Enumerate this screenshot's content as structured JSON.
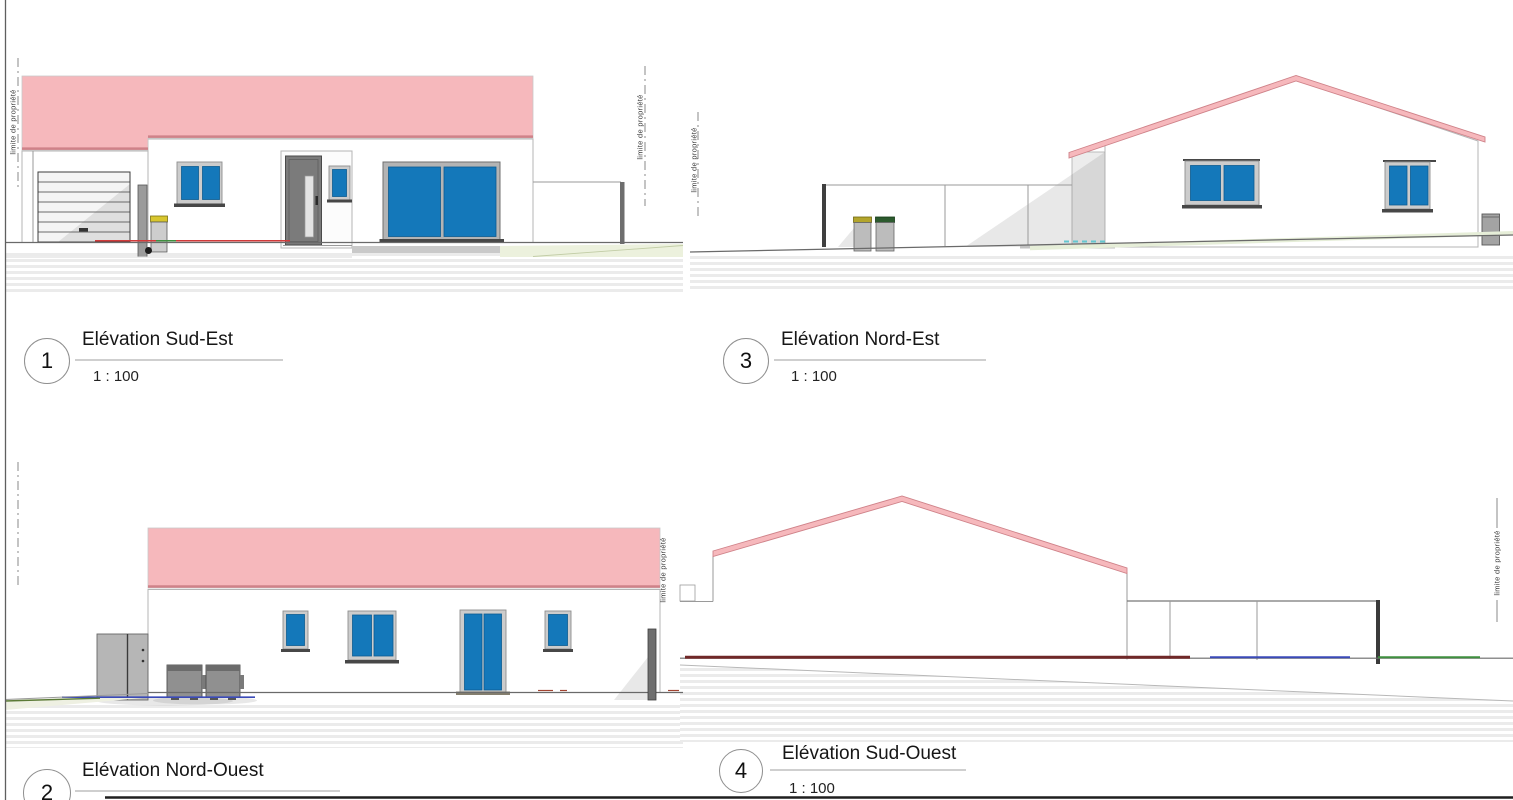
{
  "drawing": {
    "property_limit_label": "limite de propriété",
    "panels": [
      {
        "number": "1",
        "title": "Elévation Sud-Est",
        "scale": "1 : 100"
      },
      {
        "number": "2",
        "title": "Elévation Nord-Ouest"
      },
      {
        "number": "3",
        "title": "Elévation Nord-Est",
        "scale": "1 : 100"
      },
      {
        "number": "4",
        "title": "Elévation Sud-Ouest",
        "scale": "1 : 100"
      }
    ],
    "colors": {
      "roof_pink": "#f6b8bc",
      "roof_edge": "#cf8289",
      "window_blue": "#1478ba",
      "marker_red": "#d23a3a",
      "marker_green": "#3f8f3f",
      "marker_blue": "#3a4ab8",
      "marker_cyan": "#63c6cf",
      "marker_maroon": "#702828"
    }
  }
}
